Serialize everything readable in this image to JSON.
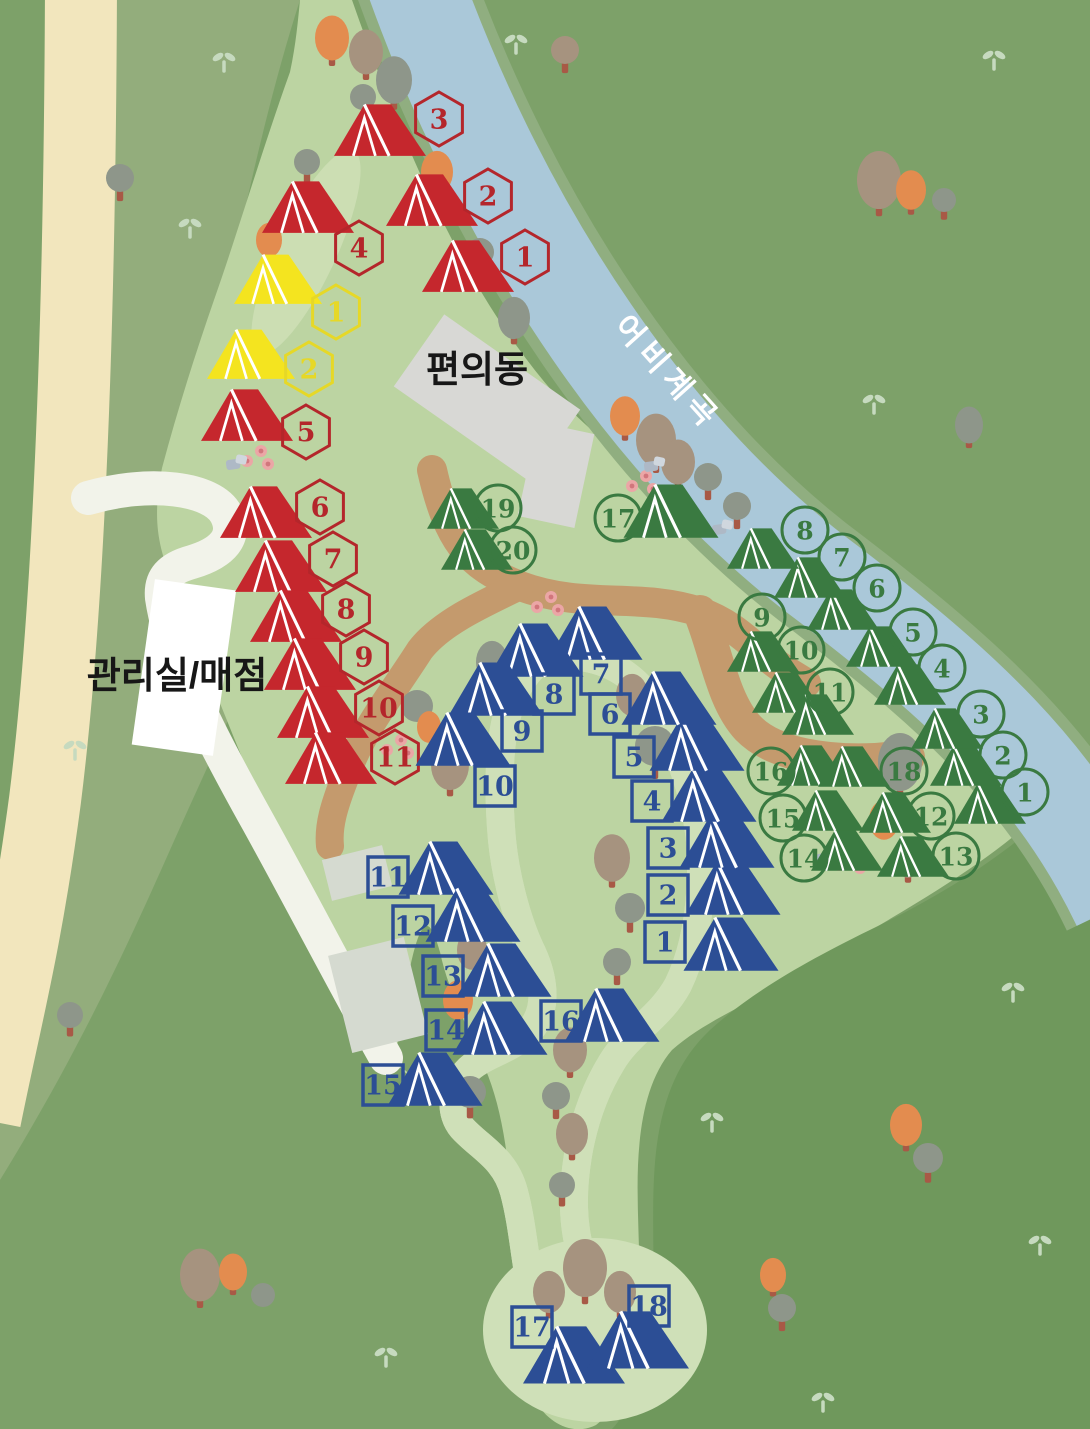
{
  "labels": {
    "river": "어비계곡",
    "convenience": "편의동",
    "office": "관리실/매점"
  },
  "colors": {
    "background": "#7da169",
    "hill_zone": "#93ad7c",
    "camp_area": "#bcd4a2",
    "light_patch": "#cfe0b8",
    "dark_southeast": "#6f985c",
    "river": "#aac8d9",
    "riverbank": "#90ae80",
    "pond": "#aac8d9",
    "pond_rim": "#cfe0b8",
    "road": "#f2e6bd",
    "walkway": "#f2f3ea",
    "trail": "#c49a6d",
    "building_gray": "#d8d8d5",
    "building_white": "#ffffff",
    "parking": "#d5dad0"
  },
  "palette": {
    "gray": "#8e968a",
    "taupe": "#a6937f",
    "orange": "#e38c4f",
    "trunk": "#a85946",
    "sprout": "#c6dabf",
    "flower": "#eba6a6",
    "flower_core": "#d1767c",
    "rock": "#aeb9c6",
    "rock_light": "#d0d7de"
  },
  "zones": {
    "red": {
      "tent_color": "#c5272d",
      "label_color": "#b4262b",
      "label_shape": "hexagon",
      "tent_scale": 0.92,
      "sites": [
        {
          "n": "1",
          "tx": 468,
          "ty": 268,
          "lx": 525,
          "ly": 257
        },
        {
          "n": "2",
          "tx": 432,
          "ty": 202,
          "lx": 488,
          "ly": 196
        },
        {
          "n": "3",
          "tx": 380,
          "ty": 132,
          "lx": 439,
          "ly": 119
        },
        {
          "n": "4",
          "tx": 308,
          "ty": 209,
          "lx": 359,
          "ly": 248
        },
        {
          "n": "5",
          "tx": 247,
          "ty": 417,
          "lx": 306,
          "ly": 432
        },
        {
          "n": "6",
          "tx": 266,
          "ty": 514,
          "lx": 320,
          "ly": 507
        },
        {
          "n": "7",
          "tx": 281,
          "ty": 568,
          "lx": 333,
          "ly": 559
        },
        {
          "n": "8",
          "tx": 296,
          "ty": 618,
          "lx": 346,
          "ly": 609
        },
        {
          "n": "9",
          "tx": 310,
          "ty": 666,
          "lx": 364,
          "ly": 657
        },
        {
          "n": "10",
          "tx": 323,
          "ty": 714,
          "lx": 379,
          "ly": 708
        },
        {
          "n": "11",
          "tx": 331,
          "ty": 760,
          "lx": 395,
          "ly": 757
        }
      ]
    },
    "yellow": {
      "tent_color": "#f4e41f",
      "label_color": "#e6d827",
      "label_shape": "hexagon",
      "tent_scale": 0.88,
      "sites": [
        {
          "n": "1",
          "tx": 278,
          "ty": 281,
          "lx": 336,
          "ly": 312
        },
        {
          "n": "2",
          "tx": 251,
          "ty": 356,
          "lx": 309,
          "ly": 369
        }
      ]
    },
    "green": {
      "tent_color": "#3a7a41",
      "label_color": "#3a7a41",
      "label_shape": "circle",
      "tent_scale": 0.72,
      "sites": [
        {
          "n": "1",
          "tx": 990,
          "ty": 805,
          "lx": 1025,
          "ly": 792
        },
        {
          "n": "2",
          "tx": 966,
          "ty": 767,
          "lx": 1003,
          "ly": 755
        },
        {
          "n": "3",
          "tx": 947,
          "ty": 730,
          "lx": 981,
          "ly": 714
        },
        {
          "n": "4",
          "tx": 910,
          "ty": 686,
          "lx": 942,
          "ly": 668
        },
        {
          "n": "5",
          "tx": 882,
          "ty": 648,
          "lx": 913,
          "ly": 632
        },
        {
          "n": "6",
          "tx": 843,
          "ty": 611,
          "lx": 877,
          "ly": 588
        },
        {
          "n": "7",
          "tx": 810,
          "ty": 579,
          "lx": 842,
          "ly": 557
        },
        {
          "n": "8",
          "tx": 763,
          "ty": 550,
          "lx": 805,
          "ly": 530
        },
        {
          "n": "9",
          "tx": 763,
          "ty": 653,
          "lx": 762,
          "ly": 617
        },
        {
          "n": "10",
          "tx": 788,
          "ty": 694,
          "lx": 801,
          "ly": 650
        },
        {
          "n": "11",
          "tx": 818,
          "ty": 716,
          "lx": 830,
          "ly": 692
        },
        {
          "n": "12",
          "tx": 895,
          "ty": 814,
          "lx": 931,
          "ly": 816
        },
        {
          "n": "13",
          "tx": 913,
          "ty": 858,
          "lx": 956,
          "ly": 856
        },
        {
          "n": "14",
          "tx": 847,
          "ty": 852,
          "lx": 804,
          "ly": 858
        },
        {
          "n": "15",
          "tx": 828,
          "ty": 812,
          "lx": 783,
          "ly": 818
        },
        {
          "n": "16",
          "tx": 813,
          "ty": 767,
          "lx": 771,
          "ly": 771
        },
        {
          "n": "17",
          "tx": 671,
          "ty": 513,
          "lx": 618,
          "ly": 518,
          "s": 0.95
        },
        {
          "n": "18",
          "tx": 854,
          "ty": 768,
          "lx": 904,
          "ly": 771
        },
        {
          "n": "19",
          "tx": 463,
          "ty": 510,
          "lx": 498,
          "ly": 508
        },
        {
          "n": "20",
          "tx": 477,
          "ty": 551,
          "lx": 513,
          "ly": 550
        }
      ]
    },
    "blue": {
      "tent_color": "#2c4e95",
      "label_color": "#2c4e95",
      "label_shape": "square",
      "tent_scale": 0.95,
      "sites": [
        {
          "n": "1",
          "tx": 731,
          "ty": 946,
          "lx": 665,
          "ly": 942
        },
        {
          "n": "2",
          "tx": 733,
          "ty": 890,
          "lx": 668,
          "ly": 895
        },
        {
          "n": "3",
          "tx": 727,
          "ty": 843,
          "lx": 668,
          "ly": 848
        },
        {
          "n": "4",
          "tx": 709,
          "ty": 797,
          "lx": 652,
          "ly": 801
        },
        {
          "n": "5",
          "tx": 697,
          "ty": 746,
          "lx": 634,
          "ly": 757
        },
        {
          "n": "6",
          "tx": 669,
          "ty": 700,
          "lx": 610,
          "ly": 714
        },
        {
          "n": "7",
          "tx": 595,
          "ty": 635,
          "lx": 601,
          "ly": 674
        },
        {
          "n": "8",
          "tx": 536,
          "ty": 652,
          "lx": 554,
          "ly": 694
        },
        {
          "n": "9",
          "tx": 496,
          "ty": 691,
          "lx": 522,
          "ly": 731
        },
        {
          "n": "10",
          "tx": 463,
          "ty": 741,
          "lx": 495,
          "ly": 786
        },
        {
          "n": "11",
          "tx": 446,
          "ty": 870,
          "lx": 388,
          "ly": 877
        },
        {
          "n": "12",
          "tx": 473,
          "ty": 917,
          "lx": 413,
          "ly": 926
        },
        {
          "n": "13",
          "tx": 504,
          "ty": 972,
          "lx": 443,
          "ly": 976
        },
        {
          "n": "14",
          "tx": 500,
          "ty": 1030,
          "lx": 446,
          "ly": 1030
        },
        {
          "n": "15",
          "tx": 435,
          "ty": 1081,
          "lx": 383,
          "ly": 1085
        },
        {
          "n": "16",
          "tx": 612,
          "ty": 1017,
          "lx": 561,
          "ly": 1021
        },
        {
          "n": "17",
          "tx": 574,
          "ty": 1357,
          "lx": 532,
          "ly": 1327,
          "s": 1.02
        },
        {
          "n": "18",
          "tx": 638,
          "ty": 1342,
          "lx": 649,
          "ly": 1306,
          "s": 1.02
        }
      ]
    }
  },
  "trees": [
    {
      "k": "egg",
      "x": 332,
      "y": 38,
      "r": 17,
      "c": "orange",
      "t": 1
    },
    {
      "k": "egg",
      "x": 366,
      "y": 52,
      "r": 17,
      "c": "taupe",
      "t": 1
    },
    {
      "k": "egg",
      "x": 394,
      "y": 80,
      "r": 18,
      "c": "gray",
      "t": 1
    },
    {
      "k": "round",
      "x": 363,
      "y": 97,
      "r": 13,
      "c": "gray",
      "t": 0
    },
    {
      "k": "round",
      "x": 565,
      "y": 50,
      "r": 14,
      "c": "taupe",
      "t": 1
    },
    {
      "k": "round",
      "x": 120,
      "y": 178,
      "r": 14,
      "c": "gray",
      "t": 1
    },
    {
      "k": "round",
      "x": 307,
      "y": 162,
      "r": 13,
      "c": "gray",
      "t": 1
    },
    {
      "k": "egg",
      "x": 879,
      "y": 180,
      "r": 22,
      "c": "taupe",
      "t": 1
    },
    {
      "k": "egg",
      "x": 911,
      "y": 190,
      "r": 15,
      "c": "orange",
      "t": 1
    },
    {
      "k": "round",
      "x": 944,
      "y": 200,
      "r": 12,
      "c": "gray",
      "t": 1
    },
    {
      "k": "egg",
      "x": 269,
      "y": 240,
      "r": 13,
      "c": "orange",
      "t": 0
    },
    {
      "k": "egg",
      "x": 437,
      "y": 172,
      "r": 16,
      "c": "orange",
      "t": 1
    },
    {
      "k": "round",
      "x": 480,
      "y": 252,
      "r": 14,
      "c": "gray",
      "t": 1
    },
    {
      "k": "egg",
      "x": 514,
      "y": 318,
      "r": 16,
      "c": "gray",
      "t": 1
    },
    {
      "k": "egg",
      "x": 625,
      "y": 416,
      "r": 15,
      "c": "orange",
      "t": 1
    },
    {
      "k": "egg",
      "x": 656,
      "y": 440,
      "r": 20,
      "c": "taupe",
      "t": 1
    },
    {
      "k": "egg",
      "x": 678,
      "y": 462,
      "r": 17,
      "c": "taupe",
      "t": 1
    },
    {
      "k": "round",
      "x": 708,
      "y": 477,
      "r": 14,
      "c": "gray",
      "t": 1
    },
    {
      "k": "round",
      "x": 737,
      "y": 506,
      "r": 14,
      "c": "gray",
      "t": 1
    },
    {
      "k": "egg",
      "x": 969,
      "y": 425,
      "r": 14,
      "c": "gray",
      "t": 1
    },
    {
      "k": "round",
      "x": 417,
      "y": 706,
      "r": 16,
      "c": "gray",
      "t": 0
    },
    {
      "k": "egg",
      "x": 429,
      "y": 727,
      "r": 12,
      "c": "orange",
      "t": 0
    },
    {
      "k": "egg",
      "x": 450,
      "y": 765,
      "r": 19,
      "c": "taupe",
      "t": 1
    },
    {
      "k": "egg",
      "x": 492,
      "y": 662,
      "r": 16,
      "c": "gray",
      "t": 0
    },
    {
      "k": "egg",
      "x": 632,
      "y": 695,
      "r": 16,
      "c": "taupe",
      "t": 1
    },
    {
      "k": "round",
      "x": 655,
      "y": 746,
      "r": 20,
      "c": "gray",
      "t": 1
    },
    {
      "k": "egg",
      "x": 612,
      "y": 858,
      "r": 18,
      "c": "taupe",
      "t": 1
    },
    {
      "k": "round",
      "x": 630,
      "y": 908,
      "r": 15,
      "c": "gray",
      "t": 1
    },
    {
      "k": "round",
      "x": 617,
      "y": 962,
      "r": 14,
      "c": "gray",
      "t": 1
    },
    {
      "k": "egg",
      "x": 900,
      "y": 762,
      "r": 22,
      "c": "gray",
      "t": 1
    },
    {
      "k": "egg",
      "x": 884,
      "y": 820,
      "r": 15,
      "c": "orange",
      "t": 0
    },
    {
      "k": "egg",
      "x": 908,
      "y": 858,
      "r": 15,
      "c": "taupe",
      "t": 1
    },
    {
      "k": "egg",
      "x": 472,
      "y": 950,
      "r": 15,
      "c": "taupe",
      "t": 0
    },
    {
      "k": "egg",
      "x": 458,
      "y": 1000,
      "r": 15,
      "c": "orange",
      "t": 0
    },
    {
      "k": "egg",
      "x": 570,
      "y": 1050,
      "r": 17,
      "c": "taupe",
      "t": 1
    },
    {
      "k": "round",
      "x": 556,
      "y": 1096,
      "r": 14,
      "c": "gray",
      "t": 1
    },
    {
      "k": "egg",
      "x": 572,
      "y": 1134,
      "r": 16,
      "c": "taupe",
      "t": 1
    },
    {
      "k": "round",
      "x": 470,
      "y": 1092,
      "r": 16,
      "c": "gray",
      "t": 1
    },
    {
      "k": "round",
      "x": 562,
      "y": 1185,
      "r": 13,
      "c": "gray",
      "t": 1
    },
    {
      "k": "egg",
      "x": 549,
      "y": 1292,
      "r": 16,
      "c": "taupe",
      "t": 1
    },
    {
      "k": "egg",
      "x": 585,
      "y": 1268,
      "r": 22,
      "c": "taupe",
      "t": 1
    },
    {
      "k": "egg",
      "x": 620,
      "y": 1292,
      "r": 16,
      "c": "taupe",
      "t": 1
    },
    {
      "k": "egg",
      "x": 906,
      "y": 1125,
      "r": 16,
      "c": "orange",
      "t": 1
    },
    {
      "k": "round",
      "x": 928,
      "y": 1158,
      "r": 15,
      "c": "gray",
      "t": 1
    },
    {
      "k": "egg",
      "x": 200,
      "y": 1275,
      "r": 20,
      "c": "taupe",
      "t": 1
    },
    {
      "k": "egg",
      "x": 233,
      "y": 1272,
      "r": 14,
      "c": "orange",
      "t": 1
    },
    {
      "k": "round",
      "x": 263,
      "y": 1295,
      "r": 12,
      "c": "gray",
      "t": 0
    },
    {
      "k": "round",
      "x": 70,
      "y": 1015,
      "r": 13,
      "c": "gray",
      "t": 1
    },
    {
      "k": "egg",
      "x": 773,
      "y": 1275,
      "r": 13,
      "c": "orange",
      "t": 1
    },
    {
      "k": "round",
      "x": 782,
      "y": 1308,
      "r": 14,
      "c": "gray",
      "t": 1
    }
  ],
  "sprouts": [
    [
      516,
      42
    ],
    [
      994,
      58
    ],
    [
      224,
      60
    ],
    [
      190,
      226
    ],
    [
      874,
      402
    ],
    [
      712,
      1120
    ],
    [
      1013,
      990
    ],
    [
      386,
      1355
    ],
    [
      823,
      1400
    ],
    [
      1040,
      1243
    ],
    [
      75,
      748
    ]
  ],
  "flowers": [
    [
      643,
      483
    ],
    [
      258,
      458
    ],
    [
      548,
      604
    ],
    [
      850,
      862
    ],
    [
      398,
      747
    ]
  ],
  "rocks": [
    [
      654,
      465
    ],
    [
      722,
      528
    ],
    [
      826,
      857
    ],
    [
      236,
      463
    ],
    [
      444,
      930
    ]
  ]
}
